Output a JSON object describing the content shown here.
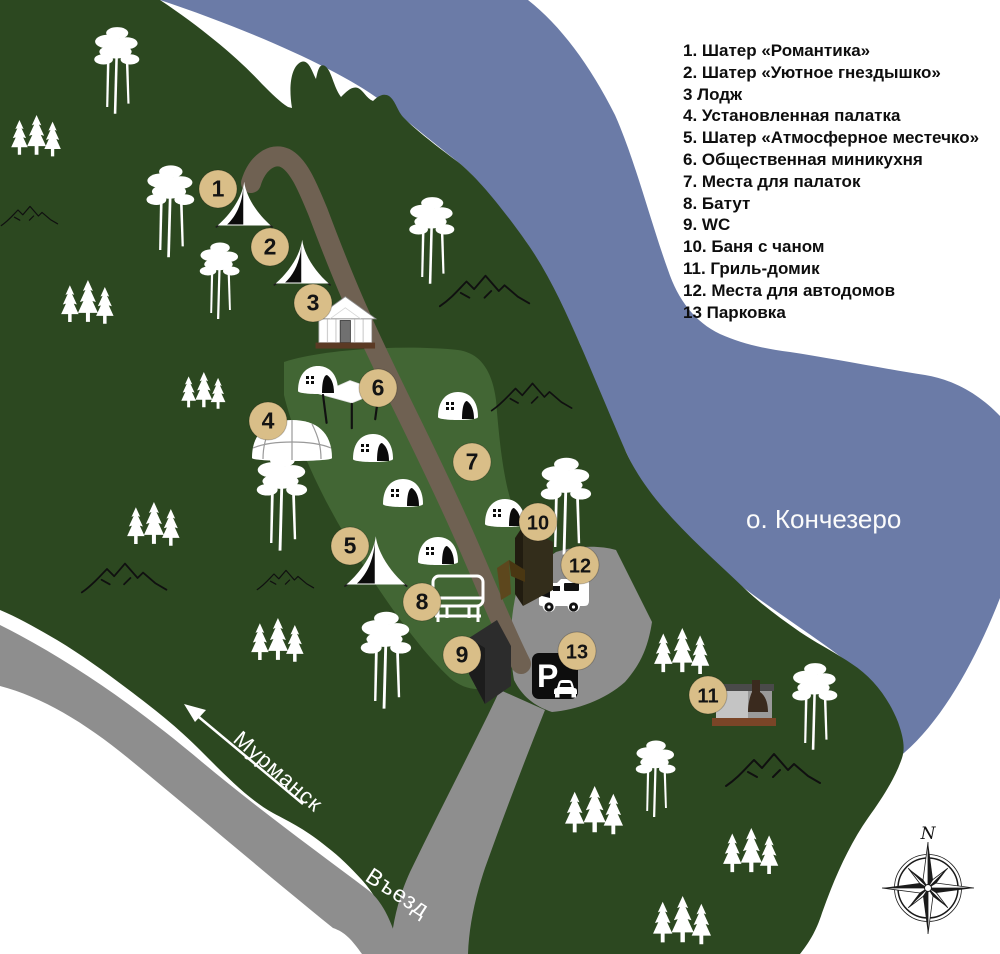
{
  "legend": {
    "items": [
      "1. Шатер «Романтика»",
      "2. Шатер «Уютное гнездышко»",
      "3 Лодж",
      "4. Установленная палатка",
      "5. Шатер «Атмосферное местечко»",
      "6. Общественная миникухня",
      "7. Места для палаток",
      "8. Батут",
      "9. WC",
      "10. Баня с чаном",
      "11. Гриль-домик",
      "12. Места для автодомов",
      "13 Парковка"
    ]
  },
  "labels": {
    "lake": "о. Кончезеро",
    "road_destination": "Мурманск",
    "entrance": "Въезд",
    "compass_north": "N",
    "parking_sign": "P"
  },
  "markers": [
    {
      "n": "1",
      "x": 218,
      "y": 189
    },
    {
      "n": "2",
      "x": 270,
      "y": 247
    },
    {
      "n": "3",
      "x": 313,
      "y": 303
    },
    {
      "n": "4",
      "x": 268,
      "y": 421
    },
    {
      "n": "5",
      "x": 350,
      "y": 546
    },
    {
      "n": "6",
      "x": 378,
      "y": 388
    },
    {
      "n": "7",
      "x": 472,
      "y": 462
    },
    {
      "n": "8",
      "x": 422,
      "y": 602
    },
    {
      "n": "9",
      "x": 462,
      "y": 655
    },
    {
      "n": "10",
      "x": 538,
      "y": 522
    },
    {
      "n": "11",
      "x": 708,
      "y": 695
    },
    {
      "n": "12",
      "x": 580,
      "y": 565
    },
    {
      "n": "13",
      "x": 577,
      "y": 651
    }
  ],
  "colors": {
    "land": "#2c4820",
    "clearing": "#426634",
    "lake": "#6b7ba7",
    "road": "#8e8e8e",
    "trail": "#6f6152",
    "marker_fill": "#d9be88",
    "marker_text": "#141414",
    "legend_text": "#0e0e0e",
    "sauna_dark": "#332d1b",
    "fence_brown": "#5d471d",
    "base_brown": "#7a4527",
    "white": "#ffffff"
  },
  "icons": {
    "compass": "compass-rose-icon",
    "bell_tent": "bell-tent-icon",
    "dome_tent": "dome-tent-icon",
    "big_dome_tent": "big-dome-tent-icon",
    "lodge": "lodge-icon",
    "canopy": "canopy-icon",
    "trampoline": "trampoline-icon",
    "rv": "rv-icon",
    "parking_sign": "parking-sign-icon",
    "sauna": "sauna-building-icon",
    "wc": "wc-building-icon",
    "grill_house": "grill-house-icon",
    "pine": "pine-trees-icon",
    "fir": "fir-trees-icon",
    "mountain": "mountain-ridge-icon",
    "arrow": "direction-arrow-icon"
  }
}
